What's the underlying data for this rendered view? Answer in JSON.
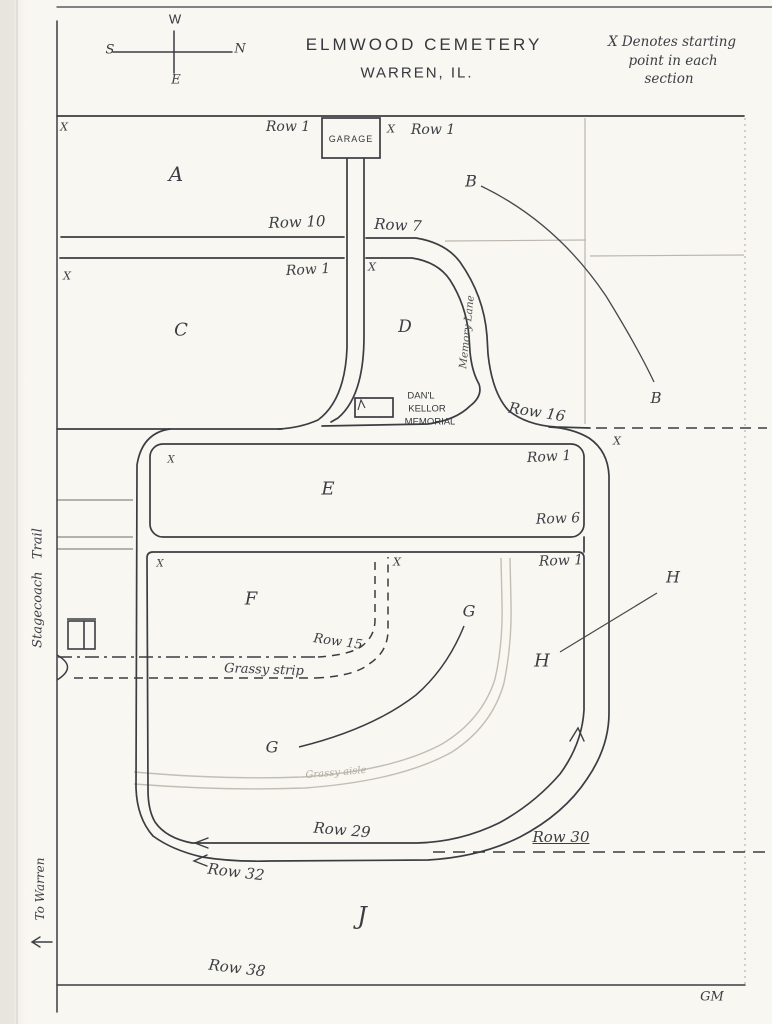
{
  "page": {
    "title": {
      "line1": "ELMWOOD CEMETERY",
      "line2": "WARREN, IL."
    },
    "legend": {
      "line1": "X Denotes starting",
      "line2": "point in each",
      "line3": "section"
    },
    "compass": {
      "n": "N",
      "s": "S",
      "e": "E",
      "w": "W"
    },
    "marker": {
      "x": "X"
    },
    "sections": {
      "a": "A",
      "b": "B",
      "c": "C",
      "d": "D",
      "e": "E",
      "f": "F",
      "g": "G",
      "h": "H",
      "j": "J"
    },
    "rows": {
      "row1": "Row 1",
      "row6": "Row 6",
      "row7": "Row 7",
      "row10": "Row 10",
      "row15": "Row 15",
      "row16": "Row 16",
      "row29": "Row 29",
      "row30": "Row 30",
      "row32": "Row 32",
      "row38": "Row 38"
    },
    "places": {
      "garage": "GARAGE",
      "memorial": {
        "line1": "DAN'L",
        "line2": "KELLOR",
        "line3": "MEMORIAL"
      },
      "memory_lane": "Memory Lane",
      "stagecoach_trail": "Stagecoach   Trail",
      "to_warren": "To Warren",
      "grassy_strip": "Grassy strip",
      "grassy_aisle": "Grassy aisle"
    },
    "initials": "GM",
    "colors": {
      "ink": "#3a3d42",
      "pencil": "#bcb7ae",
      "paper": "#f8f7f2"
    }
  }
}
